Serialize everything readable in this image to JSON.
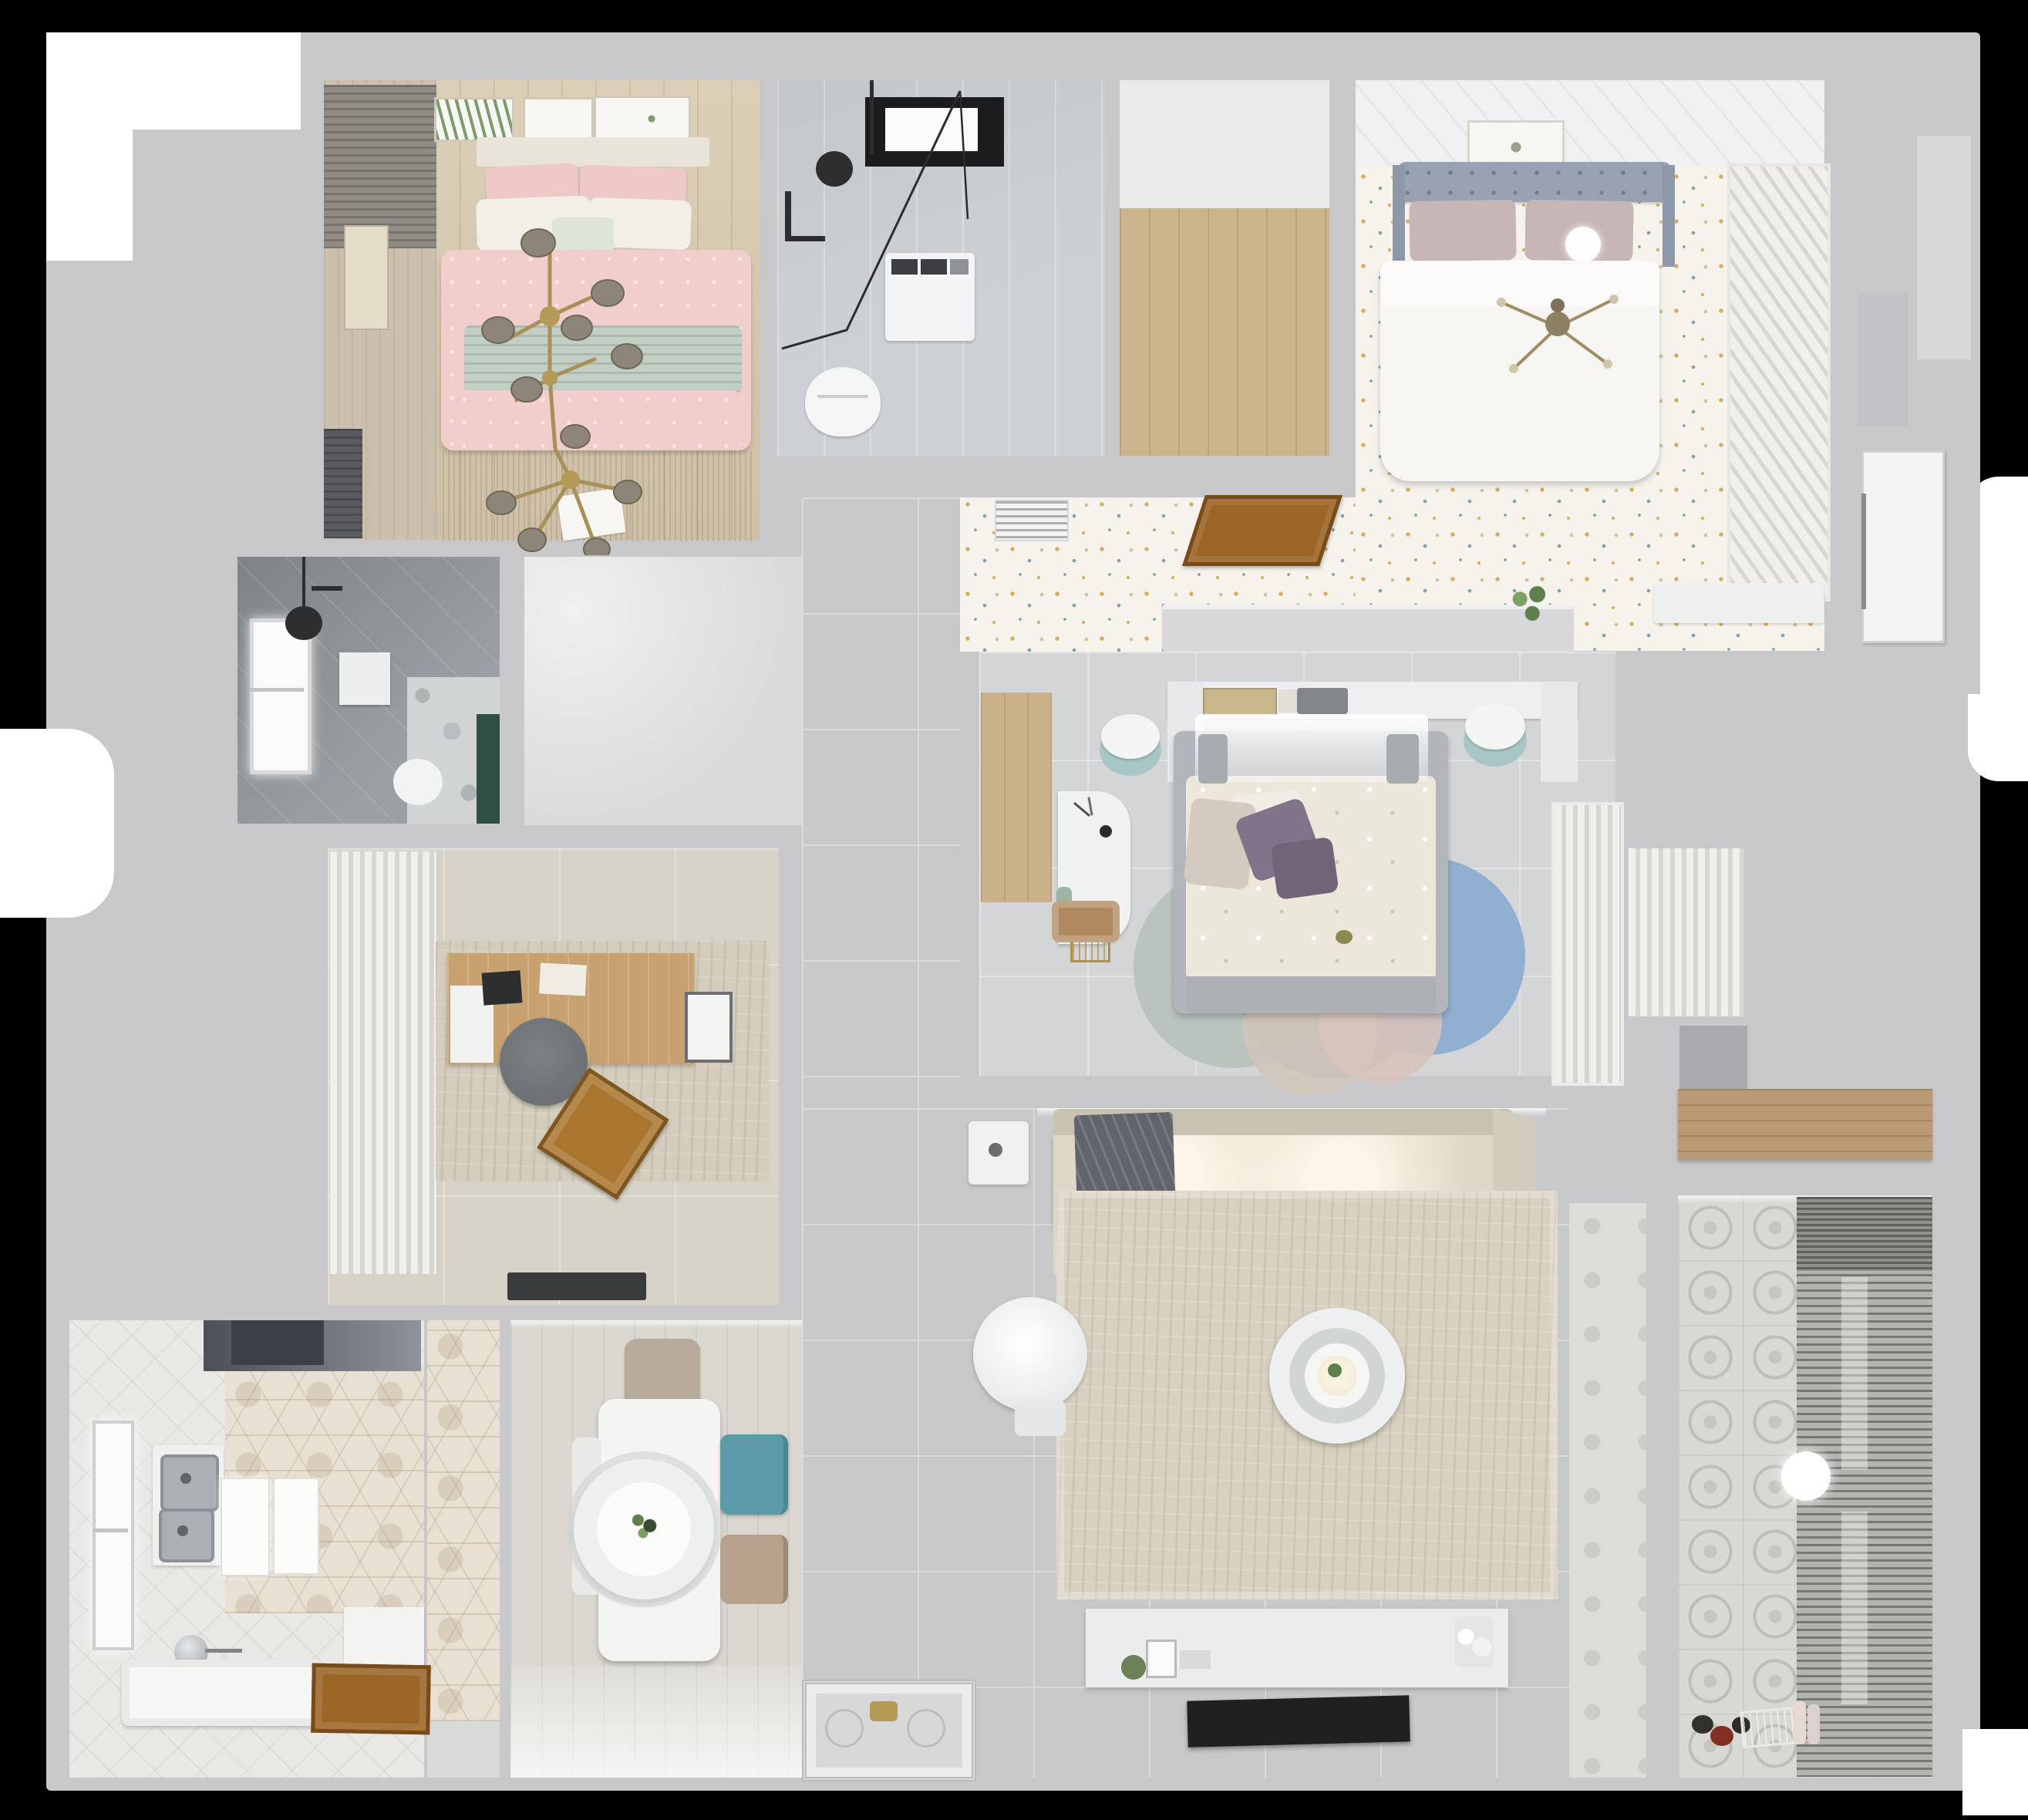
{
  "scene": {
    "type": "3d-floorplan-render",
    "view": "top-down",
    "style": "photorealistic apartment dollhouse render on black background",
    "text_visible": "none"
  },
  "palette": {
    "bg": "#000000",
    "slab": "#c8c8cb",
    "whitePatch": "#ffffff",
    "woodFloor": "#d8cab0",
    "closetWood": "#ccb48c",
    "shelfWood": "#b99a74",
    "masterWood": "#cbb28b",
    "doorBrown": "#9b6527",
    "doorBrownDark": "#7a4b1a",
    "leftWallWood": "#cbc0ae",
    "curtainDrape": "#8f8c86",
    "louverDark": "#5a5b5e",
    "frameWhite": "#f6f6f3",
    "artGreen": "#7d9b6d",
    "pinkDuvet": "#f1cecb",
    "pinkPillow": "#eec9c6",
    "whitePillow": "#f2efe9",
    "sageBand": "#c3cfc5",
    "rugTan": "#d0bc94",
    "brass": "#a8905a",
    "bulbGlass": "#8d8678",
    "bathFloor": "#cdd1d4",
    "windowDark": "#1b1c1e",
    "windowGlow": "#fafafa",
    "fixtureBlack": "#2d2e30",
    "applianceWhite": "#f3f4f5",
    "floralBase": "#f5f3ec",
    "dotGold": "#d4af62",
    "dotTeal": "#7fa3a8",
    "dotSand": "#cfc39a",
    "ceilingPanel": "#eff0f1",
    "headboardBlue": "#98a2b2",
    "pillowMauve": "#c6b6b6",
    "duvetWhite": "#f6f5f2",
    "shutterLight": "#f0efec",
    "shutterShade": "#d9d6cf",
    "hallFloor": "#c9c9cc",
    "doorWhite": "#f2f3f4",
    "masterFloor": "#d4d5d7",
    "bedFrameGray": "#b2b6ba",
    "duvetCream": "#ece7db",
    "pillowPurple": "#7f7489",
    "pillowPurpleDark": "#6f6478",
    "pillowBlushBeige": "#d5cabf",
    "rugSage": "#b7c1bb",
    "rugMauve": "#a28e98",
    "rugBlue": "#87aad0",
    "rugBeige": "#cfc5ba",
    "rugBlush": "#d8c3bb",
    "sheerWhite": "#efefec",
    "pleatShade": "#d6d6d1",
    "grayTileFloor": "#c7c8ca",
    "grout": "#d9dadb",
    "sofaBeige": "#ded7c8",
    "sofaBack": "#c9c2b3",
    "throwGray": "#61646a",
    "livingRug": "#d8d1c1",
    "tableWhite": "#f4f4f2",
    "ringGray": "#d2d5d6",
    "consoleWhite": "#ebeced",
    "tvBlack": "#1f2022",
    "balconyTile": "#d8d8d4",
    "blindSlat": "#777873",
    "blindGap": "#b3b4af",
    "nicheCab": "#a8aaad",
    "tealChair": "#5b9aa6",
    "beigeChair": "#b5a18c",
    "chairTopGray": "#b7ab9b",
    "diningFloor": "#dad7d1",
    "hexBase": "#e8e0d2",
    "bathWhiteFloor": "#e9e8e5",
    "hoodDark": "#4b4f56",
    "hoodLight": "#8e939a",
    "steel": "#aab0b4",
    "steelDark": "#8b9196",
    "tubWhite": "#f6f6f4",
    "darkBathTile": "#9aa0a4",
    "terrazzo": "#d0d4d4",
    "greenAccent": "#2e5044",
    "studyFloor": "#d7d2c8",
    "studyRug": "#d4ccbc",
    "deskWood": "#c7a170",
    "chairRound": "#6e7174",
    "trayWood": "#a9752f",
    "doormatDark": "#3a3b3d",
    "matGray": "#d8d8d8",
    "matGold": "#b59a55",
    "plantGreen": "#5f7f4e",
    "plantLight": "#7fa065",
    "stoolTeal": "#a9c6c7",
    "stoolWhite": "#f3f5f5",
    "brightWash": "#eceded"
  },
  "rooms": [
    {
      "id": "bedroom-top-left",
      "label": "pink bedroom",
      "furniture": [
        "double-bed-pink",
        "pink-pillows",
        "white-pillows",
        "sage-throw-band",
        "gold-branch-chandelier",
        "three-wall-frames",
        "side-curtains",
        "louver-shutter",
        "tan-fringe-rug"
      ]
    },
    {
      "id": "bathroom-top",
      "label": "shower bathroom",
      "furniture": [
        "black-frame-shower-glass",
        "ceiling-shower-head",
        "dark-window",
        "washing-machine",
        "toilet"
      ]
    },
    {
      "id": "walk-in-closet-top",
      "label": "walk-in closet",
      "furniture": [
        "wood-floor"
      ]
    },
    {
      "id": "bedroom-top-right",
      "label": "floral-floor bedroom",
      "furniture": [
        "tufted-blue-headboard-bed",
        "white-duvet",
        "mauve-pillows",
        "sphere-lamp",
        "cross-chandelier",
        "louvered-wardrobe",
        "wall-frame",
        "white-bench"
      ]
    },
    {
      "id": "entry-hall",
      "label": "entry hallway",
      "furniture": [
        "white-entry-door",
        "wall-niche"
      ]
    },
    {
      "id": "hall-corridor-floral",
      "label": "floral corridor",
      "furniture": [
        "open-wood-door",
        "ac-vent-grille",
        "half-wall-with-plant"
      ]
    },
    {
      "id": "bathroom-mid-left",
      "label": "dark tiled bathroom",
      "furniture": [
        "window",
        "shower-fixture",
        "wall-cabinet",
        "toilet",
        "terrazzo-wall",
        "green-accent-strip"
      ]
    },
    {
      "id": "study",
      "label": "home office",
      "furniture": [
        "wood-desk",
        "round-gray-chair",
        "wood-tray-chair",
        "monitor-board",
        "pleated-curtain-wardrobe",
        "distressed-rug",
        "dark-doormat"
      ]
    },
    {
      "id": "master-bedroom",
      "label": "master bedroom",
      "furniture": [
        "gray-frame-bed",
        "cream-floral-duvet",
        "purple-pillows",
        "headboard-shelf-with-books",
        "canopy-sheer",
        "two-tone-stool-nightstands",
        "white-desk",
        "wood-desk-chair",
        "overlapping-circle-rug",
        "sheer-wardrobe",
        "wood-floor-strip"
      ]
    },
    {
      "id": "corridor",
      "label": "tiled corridor",
      "furniture": [
        "ornate-entry-mat"
      ]
    },
    {
      "id": "living-room",
      "label": "living room",
      "furniture": [
        "l-shaped-beige-sofa",
        "dark-gray-throw",
        "big-beige-rug",
        "round-ring-coffee-table",
        "round-white-side-chair",
        "white-side-table",
        "tv-console-with-plant-and-vases",
        "wall-tv"
      ]
    },
    {
      "id": "dining-room",
      "label": "dining room",
      "furniture": [
        "white-rect-table",
        "large-disc-pendant-lamp",
        "teal-chair",
        "beige-chair",
        "gray-top-chair",
        "hex-tile-wall-strip"
      ]
    },
    {
      "id": "bathroom-bottom-left",
      "label": "bathroom with tub",
      "furniture": [
        "dark-hood-cabinet",
        "hex-feature-wall",
        "double-steel-sink-counter",
        "white-panels",
        "freestanding-tub",
        "chrome-floor-faucet",
        "open-wood-door",
        "window"
      ]
    },
    {
      "id": "storage-niche-right",
      "label": "storage niche",
      "furniture": [
        "gray-cabinet",
        "wood-counter"
      ]
    },
    {
      "id": "balcony-laundry",
      "label": "balcony / laundry",
      "furniture": [
        "venetian-blinds-wall",
        "patterned-cement-tiles",
        "white-sphere-lamp",
        "floor-toys",
        "bottles"
      ]
    }
  ]
}
